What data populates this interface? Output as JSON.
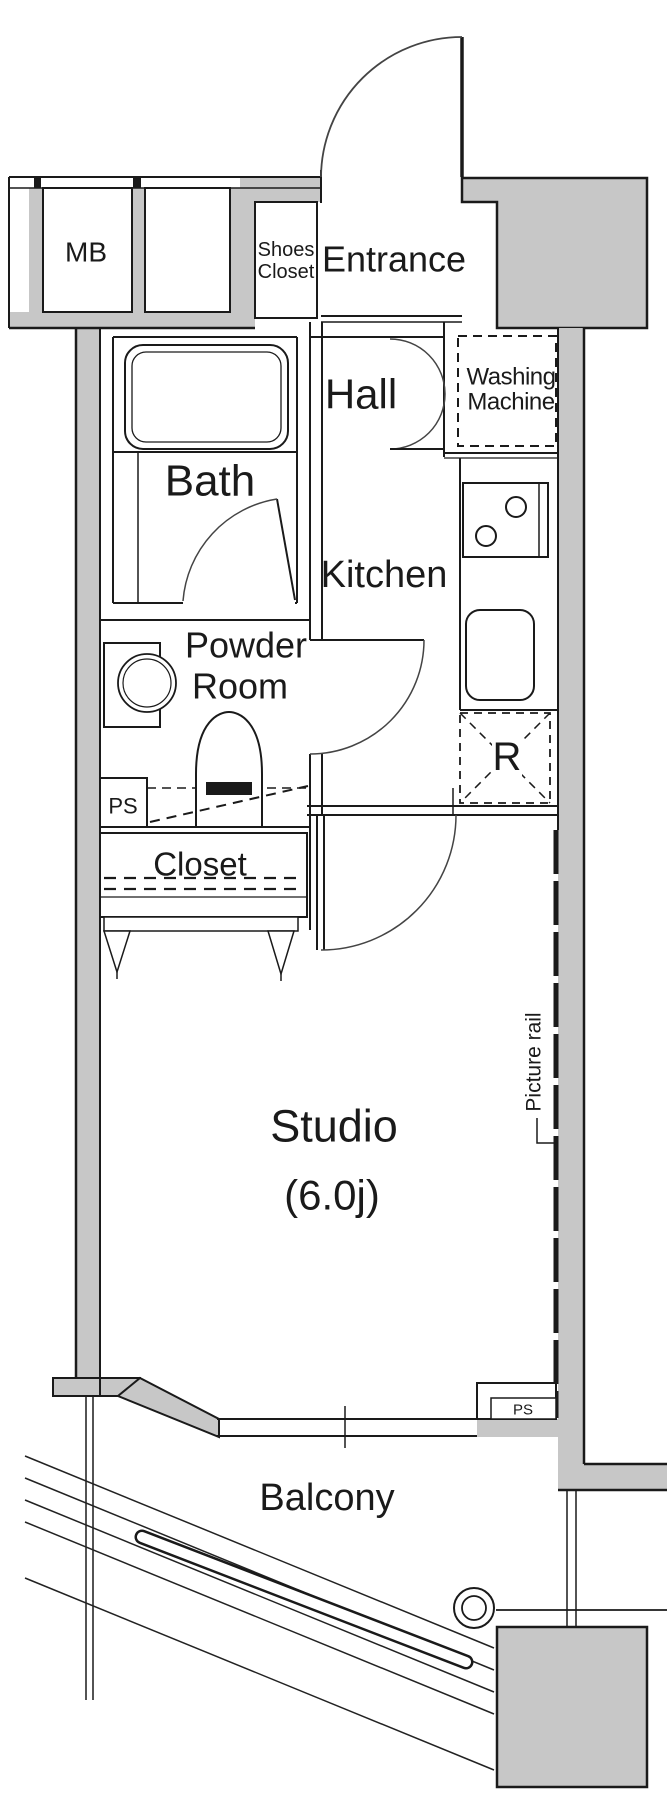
{
  "colors": {
    "wall_fill": "#c7c7c7",
    "line": "#1a1a1a",
    "arc": "#444444",
    "background": "#ffffff"
  },
  "rooms": {
    "entrance": "Entrance",
    "hall": "Hall",
    "bath": "Bath",
    "kitchen": "Kitchen",
    "powder_room": {
      "line1": "Powder",
      "line2": "Room"
    },
    "closet": "Closet",
    "studio": {
      "name": "Studio",
      "size": "(6.0j)"
    },
    "balcony": "Balcony"
  },
  "fixtures": {
    "meter_box": "MB",
    "shoes_closet": {
      "line1": "Shoes",
      "line2": "Closet"
    },
    "washing_machine": {
      "line1": "Washing",
      "line2": "Machine"
    },
    "refrigerator": "R",
    "pipe_space_powder": "PS",
    "pipe_space_window": "PS",
    "picture_rail": "Picture rail"
  }
}
